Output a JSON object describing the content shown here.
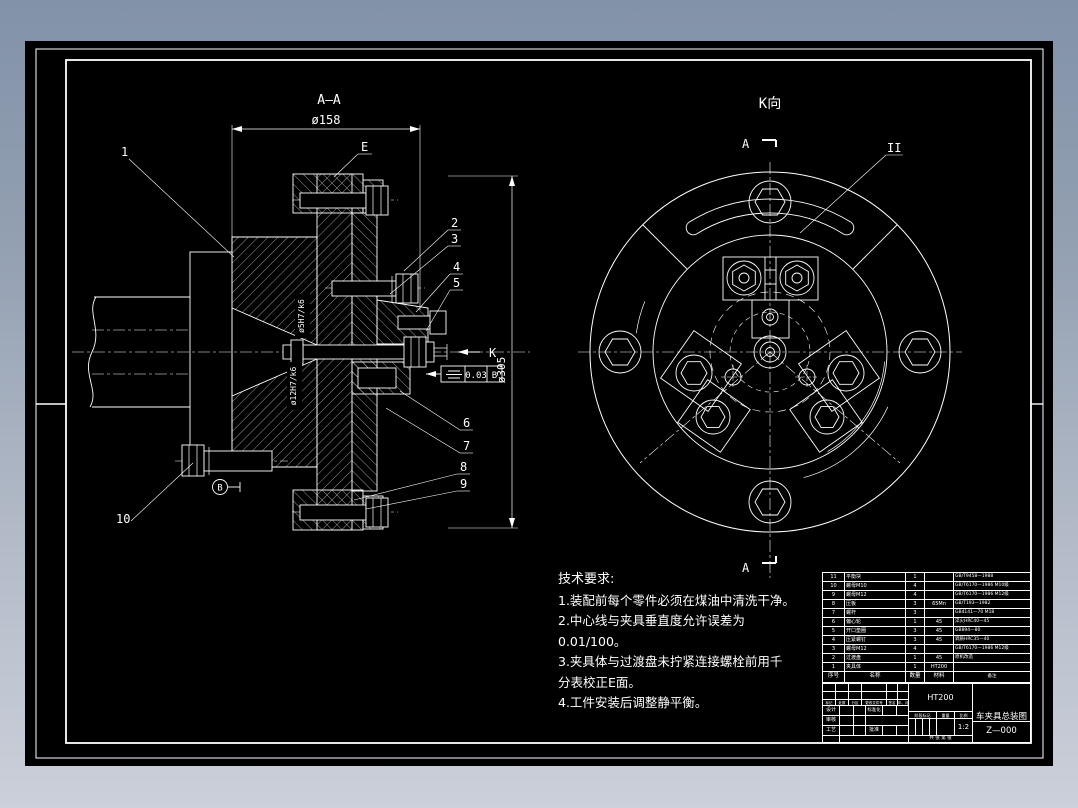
{
  "colors": {
    "canvas_bg": "#000000",
    "line": "#ffffff",
    "margin_top": "#8292a8",
    "margin_bottom": "#cbd0da"
  },
  "views": {
    "section": {
      "title": "A—A",
      "dim_top": "ø158",
      "dim_right": "ø305",
      "fit_upper": "ø5H7/k6",
      "fit_lower": "ø12H7/k6",
      "face_label": "E",
      "view_arrow_label": "K",
      "datum": "B",
      "fcf": {
        "symbol": "symmetry",
        "tolerance": "0.03",
        "datum": "B"
      },
      "balloons": [
        "1",
        "2",
        "3",
        "4",
        "5",
        "6",
        "7",
        "8",
        "9",
        "10"
      ]
    },
    "k_view": {
      "title": "K向",
      "section_label": "A",
      "detail_label": "II"
    }
  },
  "tech_requirements": {
    "title": "技术要求:",
    "lines": [
      "1.装配前每个零件必须在煤油中清洗干净。",
      "2.中心线与夹具垂直度允许误差为",
      "0.01/100。",
      "3.夹具体与过渡盘未拧紧连接螺栓前用千",
      "分表校正E面。",
      "4.工件安装后调整静平衡。"
    ]
  },
  "bom": {
    "headers": [
      "序号",
      "名称",
      "数量",
      "材料",
      "备注"
    ],
    "rows": [
      {
        "no": "11",
        "name": "平衡块",
        "qty": "1",
        "material": "",
        "remark": "GB/T9458—1988"
      },
      {
        "no": "10",
        "name": "螺母M10",
        "qty": "4",
        "material": "",
        "remark": "GB/T6170—1986 M10级"
      },
      {
        "no": "9",
        "name": "螺母M12",
        "qty": "4",
        "material": "",
        "remark": "GB/T6170—1986 M12级"
      },
      {
        "no": "8",
        "name": "压板",
        "qty": "3",
        "material": "65Mn",
        "remark": "GB/T193—1982"
      },
      {
        "no": "7",
        "name": "螺杆",
        "qty": "3",
        "material": "",
        "remark": "GB4141—70 M18"
      },
      {
        "no": "6",
        "name": "偏心轮",
        "qty": "1",
        "material": "45",
        "remark": "淬火HRC40—45"
      },
      {
        "no": "5",
        "name": "开口垫圈",
        "qty": "3",
        "material": "45",
        "remark": "GB894—80"
      },
      {
        "no": "4",
        "name": "压紧螺钉",
        "qty": "3",
        "material": "45",
        "remark": "调质HRC35—40"
      },
      {
        "no": "3",
        "name": "螺母M12",
        "qty": "4",
        "material": "",
        "remark": "GB/T6170—1986 M12级"
      },
      {
        "no": "2",
        "name": "过渡盘",
        "qty": "1",
        "material": "45",
        "remark": "原机改造"
      },
      {
        "no": "1",
        "name": "夹具体",
        "qty": "1",
        "material": "HT200",
        "remark": ""
      }
    ]
  },
  "title_block": {
    "rev_cols": [
      "标记",
      "处数",
      "分区",
      "更改文件号",
      "签名",
      "年、月、日"
    ],
    "role_design": "设计",
    "role_standard": "标准化",
    "role_check": "审核",
    "role_process": "工艺",
    "role_approve": "批准",
    "material": "HT200",
    "stage_cols": [
      "阶段标记",
      "重量",
      "比例"
    ],
    "scale": "1:2",
    "sheet_note": "共 张 第 张",
    "title": "车夹具总装图",
    "drawing_no": "Z—000"
  }
}
